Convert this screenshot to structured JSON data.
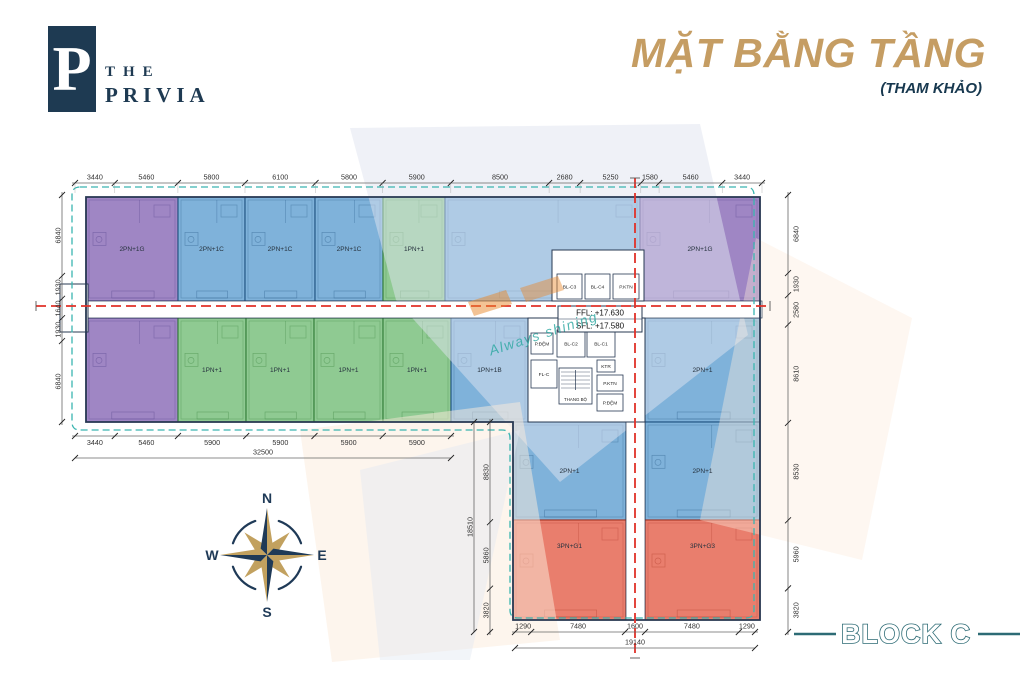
{
  "logo": {
    "monogram": "P",
    "line1": "THE",
    "line2": "PRIVIA"
  },
  "title": {
    "main": "MẶT BẰNG TẦNG",
    "sub": "(THAM KHẢO)"
  },
  "block_label": "BLOCK C",
  "watermark": {
    "slogan": "Always shining"
  },
  "compass": {
    "n": "N",
    "e": "E",
    "s": "S",
    "w": "W"
  },
  "level_box": {
    "line1": "FFL: +17.630",
    "line2": "SFL: +17.580"
  },
  "colors": {
    "navy": "#1e3a52",
    "gold": "#c59d63",
    "teal_dash": "#3ab5b0",
    "axis_red": "#e03128",
    "outline": "#273852",
    "dim_text": "#333333",
    "block_teal": "#2d6b75",
    "purple": "#9f86c4",
    "purple_dark": "#4a3a85",
    "blue": "#7fb2da",
    "blue_dark": "#1d4f7e",
    "green": "#8fca92",
    "green_dark": "#2f7a35",
    "red": "#e97e6d",
    "red_dark": "#a93524"
  },
  "plan": {
    "units": [
      {
        "id": "u1",
        "color": "purple",
        "x": 86,
        "y": 197,
        "w": 92,
        "h": 104,
        "label": "2PN+1G"
      },
      {
        "id": "u2",
        "color": "blue",
        "x": 178,
        "y": 197,
        "w": 67,
        "h": 104,
        "label": "2PN+1C"
      },
      {
        "id": "u3",
        "color": "blue",
        "x": 245,
        "y": 197,
        "w": 70,
        "h": 104,
        "label": "2PN+1C"
      },
      {
        "id": "u4",
        "color": "blue",
        "x": 315,
        "y": 197,
        "w": 68,
        "h": 104,
        "label": "2PN+1C"
      },
      {
        "id": "u5",
        "color": "green",
        "x": 383,
        "y": 197,
        "w": 62,
        "h": 104,
        "label": "1PN+1"
      },
      {
        "id": "u6",
        "color": "blue",
        "x": 445,
        "y": 197,
        "w": 195,
        "h": 104,
        "label": ""
      },
      {
        "id": "u7",
        "color": "purple",
        "x": 640,
        "y": 197,
        "w": 120,
        "h": 104,
        "label": "2PN+1G"
      },
      {
        "id": "l1",
        "color": "purple",
        "x": 86,
        "y": 318,
        "w": 92,
        "h": 104,
        "label": ""
      },
      {
        "id": "l2",
        "color": "green",
        "x": 178,
        "y": 318,
        "w": 68,
        "h": 104,
        "label": "1PN+1"
      },
      {
        "id": "l3",
        "color": "green",
        "x": 246,
        "y": 318,
        "w": 68,
        "h": 104,
        "label": "1PN+1"
      },
      {
        "id": "l4",
        "color": "green",
        "x": 314,
        "y": 318,
        "w": 69,
        "h": 104,
        "label": "1PN+1"
      },
      {
        "id": "l5",
        "color": "green",
        "x": 383,
        "y": 318,
        "w": 68,
        "h": 104,
        "label": "1PN+1"
      },
      {
        "id": "l6",
        "color": "blue",
        "x": 451,
        "y": 318,
        "w": 77,
        "h": 104,
        "label": "1PN+1B"
      },
      {
        "id": "l7",
        "color": "blue",
        "x": 645,
        "y": 318,
        "w": 115,
        "h": 104,
        "label": "2PN+1"
      },
      {
        "id": "w1",
        "color": "blue",
        "x": 513,
        "y": 422,
        "w": 113,
        "h": 98,
        "label": "2PN+1"
      },
      {
        "id": "w2",
        "color": "blue",
        "x": 645,
        "y": 422,
        "w": 115,
        "h": 98,
        "label": "2PN+1"
      },
      {
        "id": "w3",
        "color": "red",
        "x": 513,
        "y": 520,
        "w": 113,
        "h": 100,
        "label": "3PN+G1",
        "ly": 548
      },
      {
        "id": "w4",
        "color": "red",
        "x": 645,
        "y": 520,
        "w": 115,
        "h": 100,
        "label": "3PN+G3",
        "ly": 548
      }
    ],
    "core_rooms": [
      {
        "label": "BL-C3",
        "x": 557,
        "y": 274,
        "w": 25,
        "h": 25
      },
      {
        "label": "BL-C4",
        "x": 585,
        "y": 274,
        "w": 25,
        "h": 25
      },
      {
        "label": "P.KTN",
        "x": 613,
        "y": 274,
        "w": 26,
        "h": 25
      },
      {
        "label": "P.ĐỆM",
        "x": 531,
        "y": 333,
        "w": 22,
        "h": 21
      },
      {
        "label": "BL-C2",
        "x": 557,
        "y": 330,
        "w": 28,
        "h": 27
      },
      {
        "label": "BL-C1",
        "x": 587,
        "y": 330,
        "w": 28,
        "h": 27
      },
      {
        "label": "FL-C",
        "x": 531,
        "y": 360,
        "w": 26,
        "h": 28
      },
      {
        "label": "KTR",
        "x": 597,
        "y": 360,
        "w": 18,
        "h": 12
      },
      {
        "label": "P.KTN",
        "x": 597,
        "y": 375,
        "w": 26,
        "h": 16
      },
      {
        "label": "THANG BỘ",
        "x": 559,
        "y": 368,
        "w": 33,
        "h": 36,
        "stairs": true
      },
      {
        "label": "P.ĐỆM",
        "x": 597,
        "y": 394,
        "w": 26,
        "h": 17
      }
    ],
    "dimensions": {
      "top": [
        "3440",
        "5460",
        "5800",
        "6100",
        "5800",
        "5900",
        "8500",
        "2680",
        "5250",
        "1580",
        "5460",
        "3440"
      ],
      "bottom_left": {
        "segments": [
          "3440",
          "5460",
          "5900",
          "5900",
          "5900",
          "5900"
        ],
        "total": "32500"
      },
      "bottom_wing": {
        "segments": [
          "1290",
          "7480",
          "1600",
          "7480",
          "1290"
        ],
        "total": "19140"
      },
      "left": [
        "6840",
        "1930",
        "1640",
        "1930",
        "6840"
      ],
      "right": [
        "6840",
        "1930",
        "2580",
        "8610",
        "8530",
        "5960",
        "3820"
      ],
      "wing_left": {
        "segments": [
          "8830",
          "5860",
          "3820"
        ],
        "total": "18510"
      }
    }
  }
}
